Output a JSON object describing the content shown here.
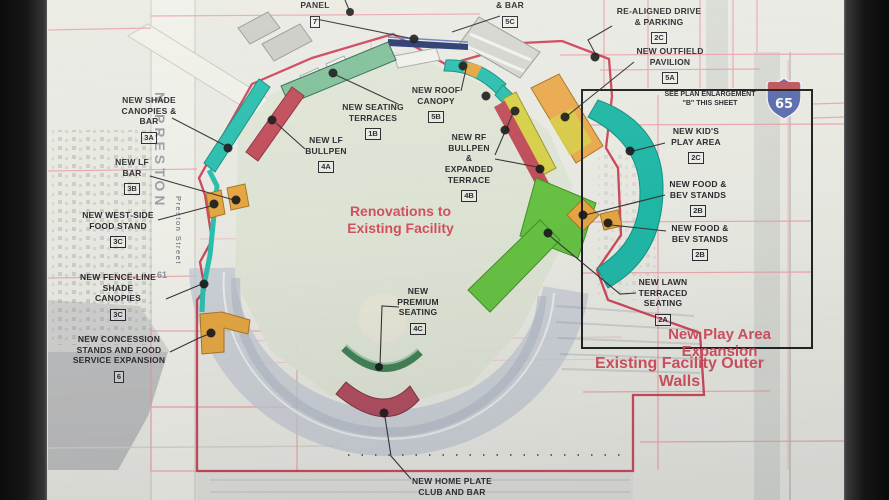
{
  "plan": {
    "callouts": [
      {
        "id": "panel",
        "lines": "PANEL",
        "tag": "7"
      },
      {
        "id": "bar",
        "lines": "& BAR",
        "tag": "5C"
      },
      {
        "id": "realigned-drive",
        "lines": "RE-ALIGNED DRIVE\n& PARKING",
        "tag": "2C"
      },
      {
        "id": "outfield-pavilion",
        "lines": "NEW OUTFIELD\nPAVILION",
        "tag": "5A"
      },
      {
        "id": "plan-enlargement-note",
        "lines": "SEE PLAN ENLARGEMENT\n\"B\" THIS SHEET"
      },
      {
        "id": "shade-canopies-bar",
        "lines": "NEW SHADE\nCANOPIES &\nBAR",
        "tag": "3A"
      },
      {
        "id": "lf-bar",
        "lines": "NEW LF\nBAR",
        "tag": "3B"
      },
      {
        "id": "west-side-food-stand",
        "lines": "NEW WEST-SIDE\nFOOD STAND",
        "tag": "3C"
      },
      {
        "id": "fence-line-shade-canopies",
        "lines": "NEW FENCE-LINE\nSHADE\nCANOPIES",
        "tag": "3C"
      },
      {
        "id": "concession-expansion",
        "lines": "NEW CONCESSION\nSTANDS AND FOOD\nSERVICE EXPANSION",
        "tag": "6"
      },
      {
        "id": "seating-terraces",
        "lines": "NEW SEATING\nTERRACES",
        "tag": "1B"
      },
      {
        "id": "lf-bullpen",
        "lines": "NEW LF\nBULLPEN",
        "tag": "4A"
      },
      {
        "id": "roof-canopy",
        "lines": "NEW ROOF\nCANOPY",
        "tag": "5B"
      },
      {
        "id": "rf-bullpen",
        "lines": "NEW RF\nBULLPEN\n&\nEXPANDED\nTERRACE",
        "tag": "4B"
      },
      {
        "id": "premium-seating",
        "lines": "NEW\nPREMIUM\nSEATING",
        "tag": "4C"
      },
      {
        "id": "kids-play-area",
        "lines": "NEW KID'S\nPLAY AREA",
        "tag": "2C"
      },
      {
        "id": "food-bev-stands-1",
        "lines": "NEW FOOD &\nBEV STANDS",
        "tag": "2B"
      },
      {
        "id": "food-bev-stands-2",
        "lines": "NEW FOOD &\nBEV STANDS",
        "tag": "2B"
      },
      {
        "id": "lawn-terraced-seating",
        "lines": "NEW LAWN\nTERRACED\nSEATING",
        "tag": "2A"
      },
      {
        "id": "home-plate-club",
        "lines": "NEW HOME PLATE\nCLUB AND BAR"
      }
    ],
    "red_notes": {
      "renovations": "Renovations to\nExisting Facility",
      "play_area_expansion": "New Play Area Expansion",
      "existing_outer_walls": "Existing Facility Outer Walls"
    },
    "streets": {
      "n_preston": "N PRESTON",
      "preston_street": "Preston Street",
      "route_61": "61"
    },
    "interstate_shield": "65",
    "colors": {
      "paper": "#eaebe3",
      "boundary_red": "#cb3248",
      "annotation_red": "#d24d5b",
      "pink_parcel_line": "#ec9ba6",
      "teal_canopy": "#27bfae",
      "terrace_green": "#7fc198",
      "lawn_green": "#64c23f",
      "stand_orange": "#e6a63e",
      "bullpen_yellow": "#d8d145",
      "band_crimson": "#c14a57",
      "panel_navy": "#27356d",
      "enlargement_box_black": "#1c1c1c",
      "interstate_blue": "#4a5da8",
      "interstate_red": "#b8444c"
    }
  }
}
